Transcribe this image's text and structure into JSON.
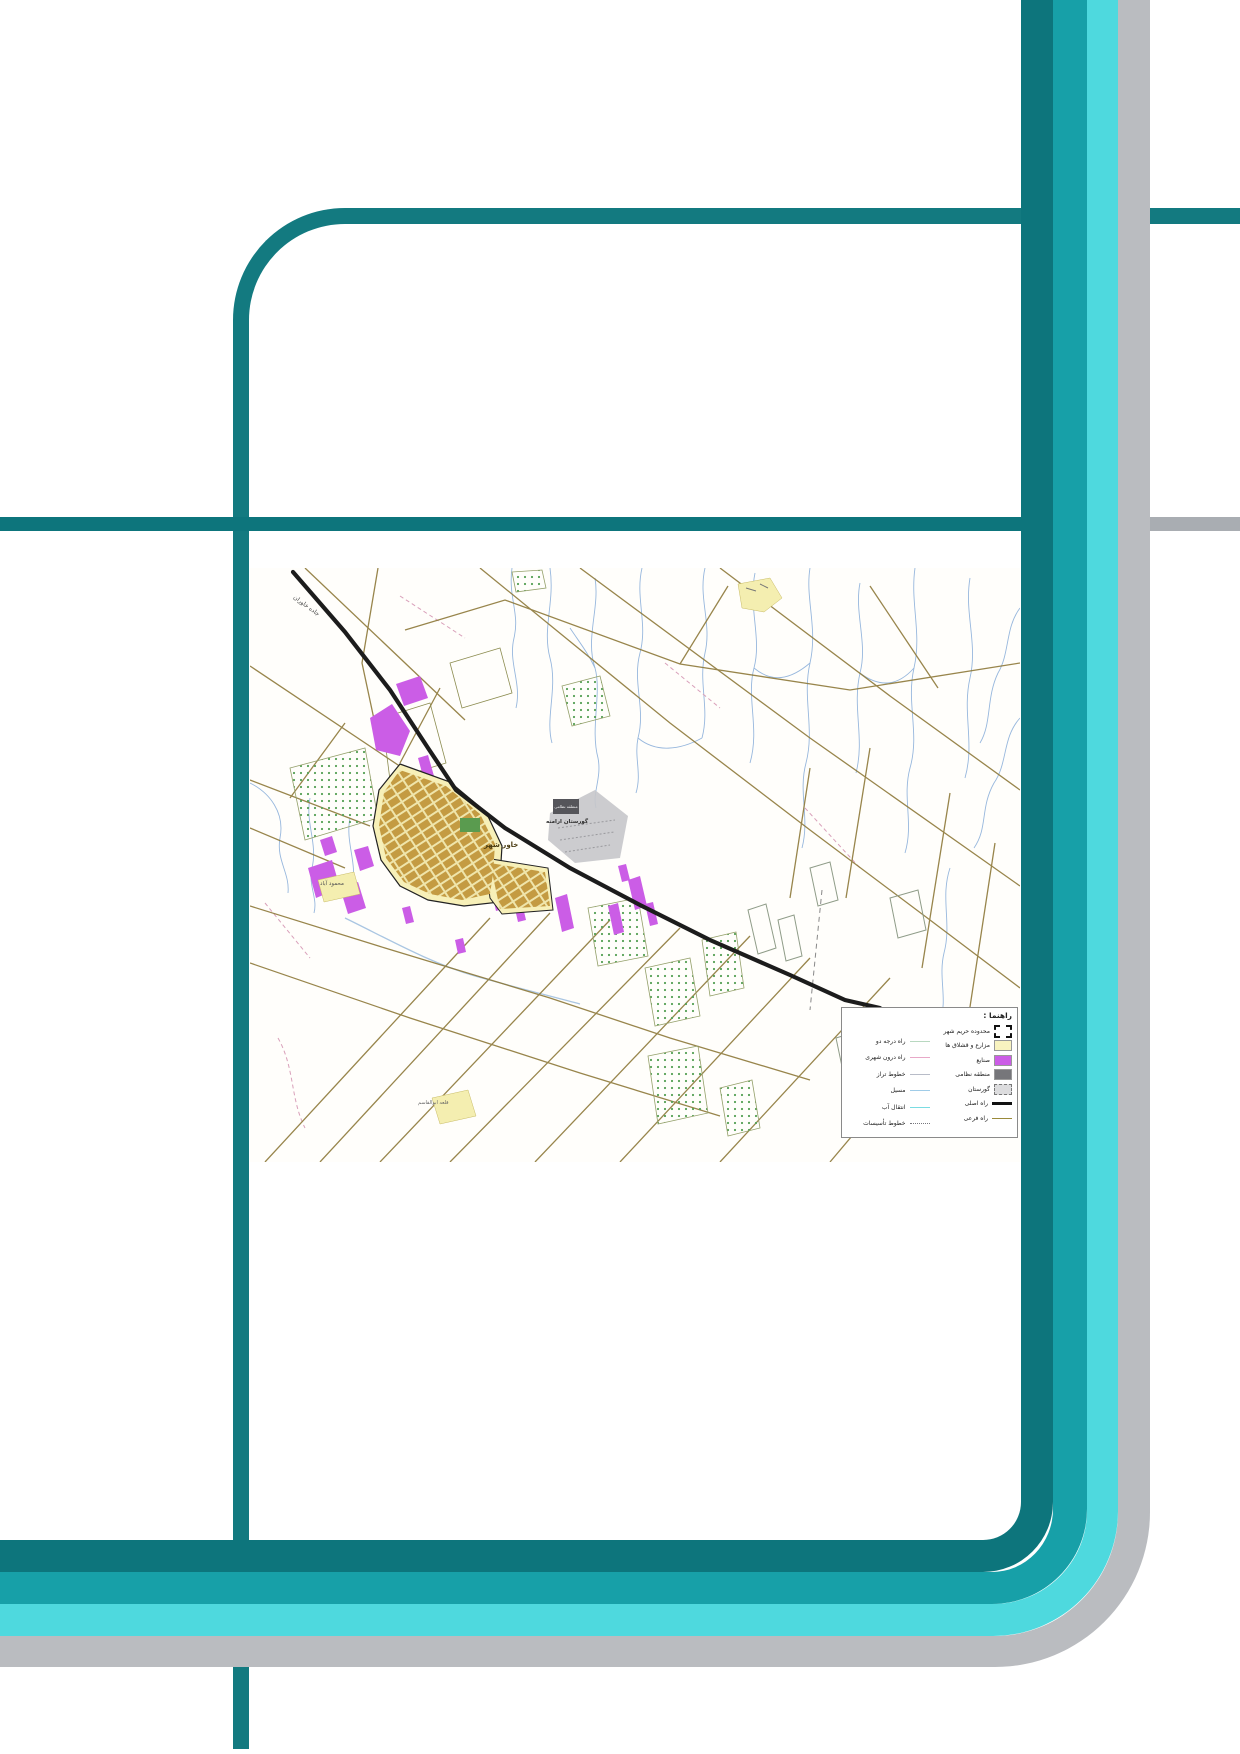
{
  "page": {
    "background": "#ffffff"
  },
  "decor": {
    "frame_color": "#137a80",
    "bands": [
      {
        "name": "dark-teal",
        "color": "#0d757c"
      },
      {
        "name": "teal",
        "color": "#17a0a8"
      },
      {
        "name": "cyan",
        "color": "#4ed9de"
      },
      {
        "name": "gray",
        "color": "#babcc0"
      }
    ],
    "rule_teal_color": "#0d757c",
    "rule_gray_color": "#a9adb2"
  },
  "map": {
    "colors": {
      "background": "#fffefb",
      "main_road": "#1c1c1c",
      "dirt_roads": "#8d7839",
      "streams": "#92b4dc",
      "city_fill": "#f7f0b8",
      "city_grid": "#c49b42",
      "industry": "#cb5de6",
      "military": "#55555a",
      "cemetery_area": "#c7c7ca",
      "orchard_dots": "#55a055",
      "village_fill": "#f4eeb0"
    },
    "labels": {
      "road": "جاده خاوران",
      "military": "منطقه نظامی",
      "cemetery": "گورستان ارامنه",
      "city": "خاور شهر",
      "village_sw": "محمود آباد",
      "village_s": "قلعه ابوالقاسم"
    },
    "legend": {
      "header": "راهنما :",
      "right_items": [
        {
          "label": "محدوده حریم شهر",
          "symbol": "dashed-boundary",
          "color": "#111111"
        },
        {
          "label": "مزارع و قشلاق ها",
          "symbol": "swatch",
          "color": "#f8f3c0"
        },
        {
          "label": "صنایع",
          "symbol": "swatch",
          "color": "#cb5de6"
        },
        {
          "label": "منطقه نظامی",
          "symbol": "swatch",
          "color": "#76767a"
        },
        {
          "label": "گورستان",
          "symbol": "swatch-dashed",
          "color": "#dcdcde"
        },
        {
          "label": "راه اصلی",
          "symbol": "thick-line",
          "color": "#111111"
        },
        {
          "label": "راه فرعی",
          "symbol": "thin-line",
          "color": "#9a8a3a"
        }
      ],
      "left_items": [
        {
          "label": "راه درجه دو",
          "symbol": "line",
          "color": "#b8d8c0"
        },
        {
          "label": "راه درون شهری",
          "symbol": "line",
          "color": "#e8a8c8"
        },
        {
          "label": "خطوط تراز",
          "symbol": "line",
          "color": "#b8bcc8"
        },
        {
          "label": "مسیل",
          "symbol": "line",
          "color": "#a0cce8"
        },
        {
          "label": "انتقال آب",
          "symbol": "line",
          "color": "#7adce2"
        },
        {
          "label": "خطوط تأسیسات",
          "symbol": "dotted-line",
          "color": "#77777d"
        }
      ]
    }
  }
}
